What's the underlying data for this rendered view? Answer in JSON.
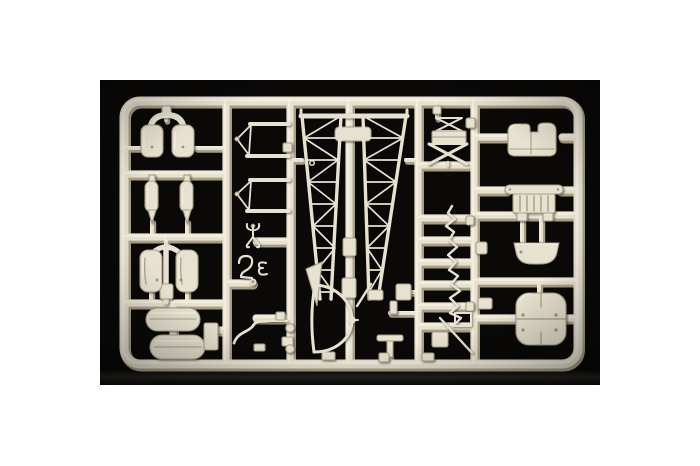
{
  "scene": {
    "description": "Photograph of an ivory injection-molded model kit sprue (parts tree) on a black studio background with white page margins",
    "background": "black",
    "plastic": "ivory cream",
    "parts": [
      {
        "name": "twin-pod-yoke"
      },
      {
        "name": "bomb-left"
      },
      {
        "name": "bomb-right"
      },
      {
        "name": "float-pod-pair"
      },
      {
        "name": "tire-upper"
      },
      {
        "name": "tire-lower"
      },
      {
        "name": "axle-block"
      },
      {
        "name": "strut-triangle-upper"
      },
      {
        "name": "strut-triangle-lower"
      },
      {
        "name": "grapple-hook"
      },
      {
        "name": "exhaust-squiggle"
      },
      {
        "name": "bent-tow-wire"
      },
      {
        "name": "runner-knobs"
      },
      {
        "name": "truss-side-frame-left"
      },
      {
        "name": "truss-side-frame-right"
      },
      {
        "name": "tail-fin"
      },
      {
        "name": "rudder-outline"
      },
      {
        "name": "cross-brace-stack"
      },
      {
        "name": "rigging-zigzag"
      },
      {
        "name": "long-thin-strut"
      },
      {
        "name": "small-brackets"
      },
      {
        "name": "tail-skid-tee"
      },
      {
        "name": "engine-cowl"
      },
      {
        "name": "engine-block"
      },
      {
        "name": "cockpit-tub"
      },
      {
        "name": "roof-panel"
      }
    ]
  },
  "colors": {
    "page_background": "#ffffff",
    "photo_background": "#0a0908",
    "photo_floor_reflection": "#26231d",
    "plastic_main": "#e7e1cf",
    "plastic_highlight": "#f5f1e3",
    "plastic_shadow": "#a89f86",
    "plastic_deep_shadow": "#857c64",
    "plastic_detail": "#8f8670"
  }
}
